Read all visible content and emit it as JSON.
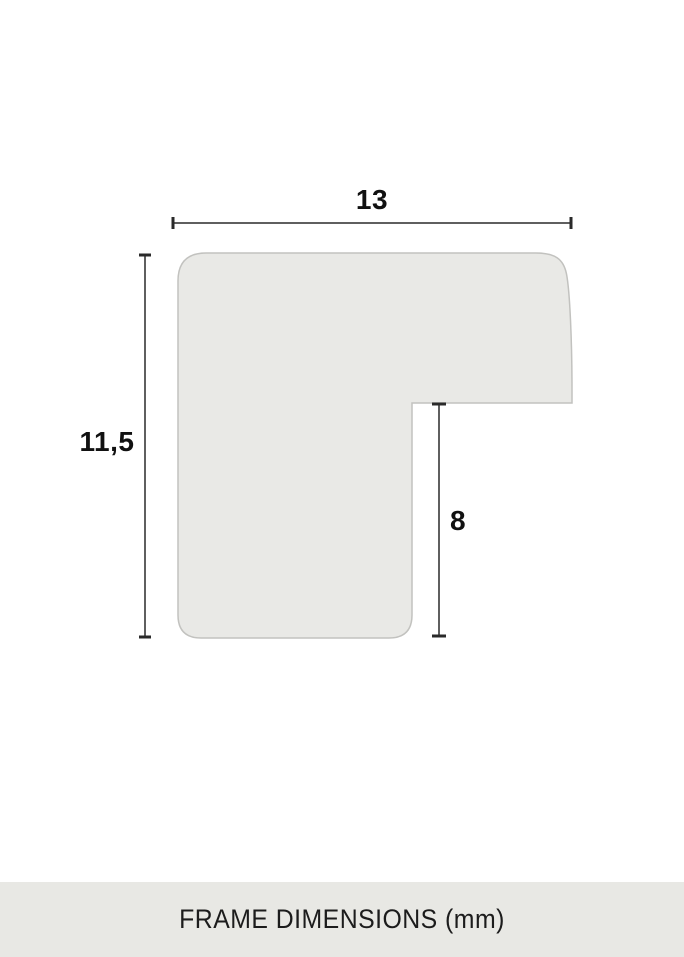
{
  "diagram": {
    "caption": "FRAME DIMENSIONS (mm)",
    "unit": "mm",
    "dimensions": {
      "width": {
        "label": "13",
        "value": 13
      },
      "height": {
        "label": "11,5",
        "value": 11.5
      },
      "rabbet_depth": {
        "label": "8",
        "value": 8
      }
    },
    "colors": {
      "background": "#ffffff",
      "profile_fill": "#e9e9e6",
      "profile_stroke": "#c2c2bf",
      "dimension_line": "#5f5f5f",
      "tick": "#2a2a2a",
      "label_text": "#111111",
      "footer_bg": "#e8e8e4",
      "footer_text": "#1c1c1c"
    }
  }
}
